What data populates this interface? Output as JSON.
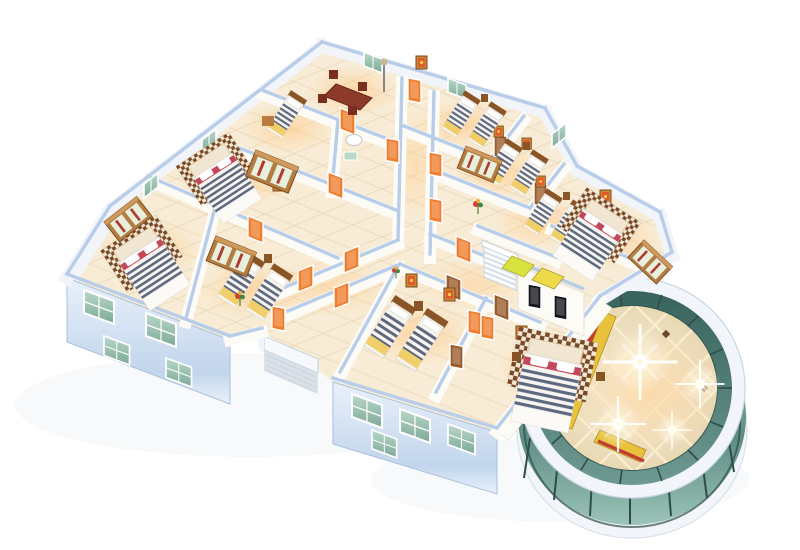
{
  "scene": {
    "type": "isometric-3d-floorplan-render",
    "description": "3D cutaway floor plan render of a residential floor: a dining room and many bedrooms with navy striped beds, wooden wardrobes and orange doors along T-shaped corridors; light-blue cut wall caps, cream tile floors with warm glow, blue exterior facades with teal glass windows, an exterior escape stair, an interior staircase and elevator core with two black doors and yellow pads, and a circular glass atrium rotunda with polished floor, diagonal grid and bright light flares at the lower right.",
    "rooms": [
      "dining room",
      "single bedroom",
      "bathroom",
      "master bedroom upper-left",
      "master bedroom left wing",
      "twin bedroom left wing",
      "twin bedroom 1",
      "twin bedroom 2",
      "twin bedroom 3",
      "master bedroom east",
      "twin bedroom south",
      "master bedroom south",
      "stair core",
      "elevator core",
      "glass rotunda atrium"
    ],
    "bed_count": 14,
    "flare_count": 4
  },
  "colors": {
    "bg": "#ffffff",
    "shadow": "#9fb0c4",
    "floor": "#f8ecd6",
    "floorLine": "#e2cda9",
    "glow": "#ffcf92",
    "wallFace": "#fdfbf6",
    "wallExt": "#f1f4f8",
    "wallCap": "#b7cde9",
    "facadeTop": "#e9f1fb",
    "facadeBottom": "#c2d5ec",
    "facadeEdge": "#aac0dc",
    "glassLight": "#b9d8c9",
    "glassDark": "#7da996",
    "doorOrange": "#ef7e2d",
    "doorBrown": "#9a5a2a",
    "wood": "#b97a3e",
    "woodDark": "#8a5526",
    "wardrobeDoor": "#e9efdb",
    "wardrobeStripe": "#b03a32",
    "bedBase": "#f7f5f0",
    "bedStripe": "#5d6880",
    "bedYellow": "#f0cf6a",
    "bedRed": "#c4475a",
    "check1": "#7a4a28",
    "check2": "#f0e6d2",
    "rotundaRing": "#f2f5f9",
    "rotundaGlass1": "#38625c",
    "rotundaGlass2": "#6e9a92",
    "rotundaGlassFront1": "#9cc3b8",
    "rotundaGlassFront2": "#5e8d84",
    "rotundaMullion": "#2e4d48",
    "rotundaFloor": "#e9d8b4",
    "rotundaGrid": "#fbf0d4",
    "escRed": "#c23b34",
    "escYellow": "#e8c23a",
    "elevatorDoor": "#16161c",
    "padYellow": "#eddc4a",
    "padYellow2": "#d9e23f",
    "paintFrame": "#c98a3a",
    "paintArt": "#e05a2a"
  }
}
